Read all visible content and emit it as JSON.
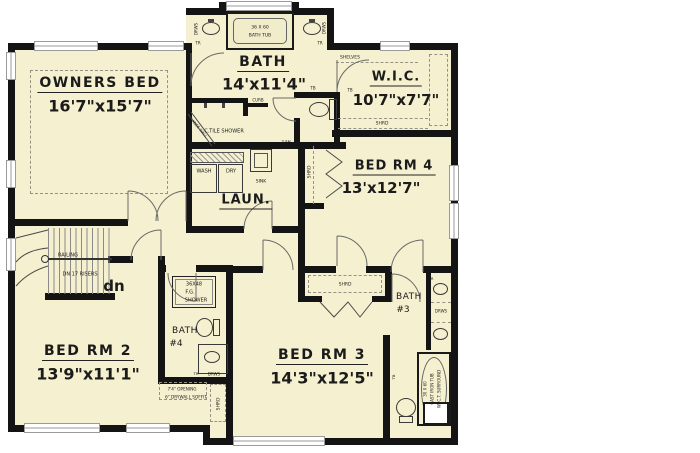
{
  "meta": {
    "drawing_type": "residential second-floor plan",
    "level_note": "dn 17 risers stair"
  },
  "colors": {
    "floor": "#f5f0cf",
    "wall": "#141414",
    "thin_line": "#555555",
    "dash": "#979286",
    "window": "#9a9a9a"
  },
  "rooms": [
    {
      "name": "OWNERS BED",
      "dims": "16'7\"x15'7\""
    },
    {
      "name": "BATH",
      "dims": "14'x11'4\""
    },
    {
      "name": "W.I.C.",
      "dims": "10'7\"x7'7\""
    },
    {
      "name": "BED RM 4",
      "dims": "13'x12'7\""
    },
    {
      "name": "LAUN.",
      "dims": ""
    },
    {
      "name": "BED RM 2",
      "dims": "13'9\"x11'1\""
    },
    {
      "name": "BED RM 3",
      "dims": "14'3\"x12'5\""
    },
    {
      "name": "BATH #3",
      "dims": ""
    },
    {
      "name": "BATH #4",
      "dims": ""
    }
  ],
  "labels": [
    {
      "id": "owners-bed-name",
      "t": "OWNERS BED",
      "x": 100,
      "y": 84,
      "s": 14,
      "u": true,
      "sp": 1.5
    },
    {
      "id": "owners-bed-dims",
      "t": "16'7\"x15'7\"",
      "x": 100,
      "y": 106,
      "s": 16,
      "b": true
    },
    {
      "id": "bath-name",
      "t": "BATH",
      "x": 263,
      "y": 63,
      "s": 14,
      "u": true,
      "sp": 1.5
    },
    {
      "id": "bath-dims",
      "t": "14'x11'4\"",
      "x": 264,
      "y": 84,
      "s": 16,
      "b": true
    },
    {
      "id": "wic-name",
      "t": "W.I.C.",
      "x": 396,
      "y": 78,
      "s": 13,
      "u": true,
      "sp": 1
    },
    {
      "id": "wic-dims",
      "t": "10'7\"x7'7\"",
      "x": 396,
      "y": 100,
      "s": 15,
      "b": true
    },
    {
      "id": "bedrm4-name",
      "t": "BED RM 4",
      "x": 394,
      "y": 167,
      "s": 13,
      "u": true,
      "sp": 1
    },
    {
      "id": "bedrm4-dims",
      "t": "13'x12'7\"",
      "x": 381,
      "y": 188,
      "s": 15,
      "b": true
    },
    {
      "id": "laun-name",
      "t": "LAUN.",
      "x": 246,
      "y": 201,
      "s": 13,
      "u": true,
      "sp": 1
    },
    {
      "id": "bedrm2-name",
      "t": "BED RM 2",
      "x": 88,
      "y": 352,
      "s": 14,
      "u": true,
      "sp": 1.5
    },
    {
      "id": "bedrm2-dims",
      "t": "13'9\"x11'1\"",
      "x": 88,
      "y": 374,
      "s": 16,
      "b": true
    },
    {
      "id": "bedrm3-name",
      "t": "BED RM 3",
      "x": 322,
      "y": 356,
      "s": 14,
      "u": true,
      "sp": 1.5
    },
    {
      "id": "bedrm3-dims",
      "t": "14'3\"x12'5\"",
      "x": 322,
      "y": 378,
      "s": 16,
      "b": true
    },
    {
      "id": "bath3-line1",
      "t": "BATH",
      "x": 409,
      "y": 297,
      "s": 9,
      "sp": 0.5
    },
    {
      "id": "bath3-line2",
      "t": "#3",
      "x": 403,
      "y": 310,
      "s": 9
    },
    {
      "id": "bath4-line1",
      "t": "BATH",
      "x": 185,
      "y": 331,
      "s": 9,
      "sp": 0.5
    },
    {
      "id": "bath4-line2",
      "t": "#4",
      "x": 176,
      "y": 344,
      "s": 9
    },
    {
      "id": "dn-label",
      "t": "dn",
      "x": 114,
      "y": 286,
      "s": 15,
      "b": true
    },
    {
      "id": "railing",
      "t": "RAILING",
      "x": 68,
      "y": 255,
      "s": 5
    },
    {
      "id": "dn-risers",
      "t": "DN 17 RISERS",
      "x": 80,
      "y": 274,
      "s": 5
    },
    {
      "id": "master-tub-size",
      "t": "36 X 60",
      "x": 260,
      "y": 27,
      "s": 4.5
    },
    {
      "id": "master-tub-name",
      "t": "BATH TUB",
      "x": 260,
      "y": 35,
      "s": 4.5
    },
    {
      "id": "drws-master-left",
      "t": "DRWS",
      "x": 196,
      "y": 29,
      "s": 4,
      "r": -90
    },
    {
      "id": "drws-master-right",
      "t": "DRWS",
      "x": 324,
      "y": 28,
      "s": 4,
      "r": -90
    },
    {
      "id": "tr-master-left",
      "t": "TR",
      "x": 198,
      "y": 43,
      "s": 4
    },
    {
      "id": "tr-master-right",
      "t": "TR",
      "x": 320,
      "y": 43,
      "s": 4
    },
    {
      "id": "ctile-shower",
      "t": "C.TILE SHOWER",
      "x": 224,
      "y": 131,
      "s": 5
    },
    {
      "id": "curb",
      "t": "CURB",
      "x": 258,
      "y": 100,
      "s": 4
    },
    {
      "id": "knee-wall",
      "t": "4' KNEE WALL",
      "x": 198,
      "y": 127,
      "s": 3.8,
      "r": 50
    },
    {
      "id": "three-sh",
      "t": "3 SH",
      "x": 286,
      "y": 142,
      "s": 4
    },
    {
      "id": "tb-1",
      "t": "TB",
      "x": 313,
      "y": 88,
      "s": 4
    },
    {
      "id": "tb-2",
      "t": "TB",
      "x": 350,
      "y": 90,
      "s": 4
    },
    {
      "id": "shelves",
      "t": "SHELVES",
      "x": 350,
      "y": 57,
      "s": 4.5
    },
    {
      "id": "shrd-wic",
      "t": "SHRD",
      "x": 382,
      "y": 123,
      "s": 4.5
    },
    {
      "id": "shrd-bedrm4-closet",
      "t": "SHRD",
      "x": 309,
      "y": 172,
      "s": 4.5,
      "r": -90
    },
    {
      "id": "shrd-bedrm3-closet",
      "t": "SHRD",
      "x": 345,
      "y": 284,
      "s": 4.5
    },
    {
      "id": "shrd-bath4-closet",
      "t": "SHRD",
      "x": 218,
      "y": 404,
      "s": 4.5,
      "r": -90
    },
    {
      "id": "wash",
      "t": "WASH",
      "x": 204,
      "y": 171,
      "s": 5
    },
    {
      "id": "dry",
      "t": "DRY",
      "x": 231,
      "y": 171,
      "s": 5
    },
    {
      "id": "laun-sink",
      "t": "SINK",
      "x": 261,
      "y": 181,
      "s": 4.5
    },
    {
      "id": "fg-shower-1",
      "t": "36X48",
      "x": 194,
      "y": 284,
      "s": 5
    },
    {
      "id": "fg-shower-2",
      "t": "F.G.",
      "x": 190,
      "y": 292,
      "s": 5
    },
    {
      "id": "fg-shower-3",
      "t": "SHOWER",
      "x": 196,
      "y": 300,
      "s": 5
    },
    {
      "id": "opening-note-1",
      "t": "7'4\" OPENING",
      "x": 182,
      "y": 389,
      "s": 4.2
    },
    {
      "id": "opening-note-2",
      "t": "6\" DRYWALL SOFFIT",
      "x": 186,
      "y": 397,
      "s": 4.2
    },
    {
      "id": "cast-tub-1",
      "t": "30 X 60",
      "x": 425,
      "y": 389,
      "s": 4,
      "r": -90
    },
    {
      "id": "cast-tub-2",
      "t": "CAST IRON TUB",
      "x": 432,
      "y": 389,
      "s": 4,
      "r": -90
    },
    {
      "id": "cast-tub-3",
      "t": "W/ C.T. SURROUND",
      "x": 439,
      "y": 389,
      "s": 4,
      "r": -90
    },
    {
      "id": "drws-bath3",
      "t": "DRWS",
      "x": 441,
      "y": 311,
      "s": 4
    },
    {
      "id": "tr-bath3",
      "t": "TR",
      "x": 431,
      "y": 279,
      "s": 3.8
    },
    {
      "id": "tb-bath3",
      "t": "TB",
      "x": 394,
      "y": 377,
      "s": 3.8,
      "r": -90
    },
    {
      "id": "drws-bath4",
      "t": "DRWS",
      "x": 214,
      "y": 374,
      "s": 4
    },
    {
      "id": "tr-bath4",
      "t": "TR",
      "x": 196,
      "y": 374,
      "s": 3.8
    }
  ]
}
